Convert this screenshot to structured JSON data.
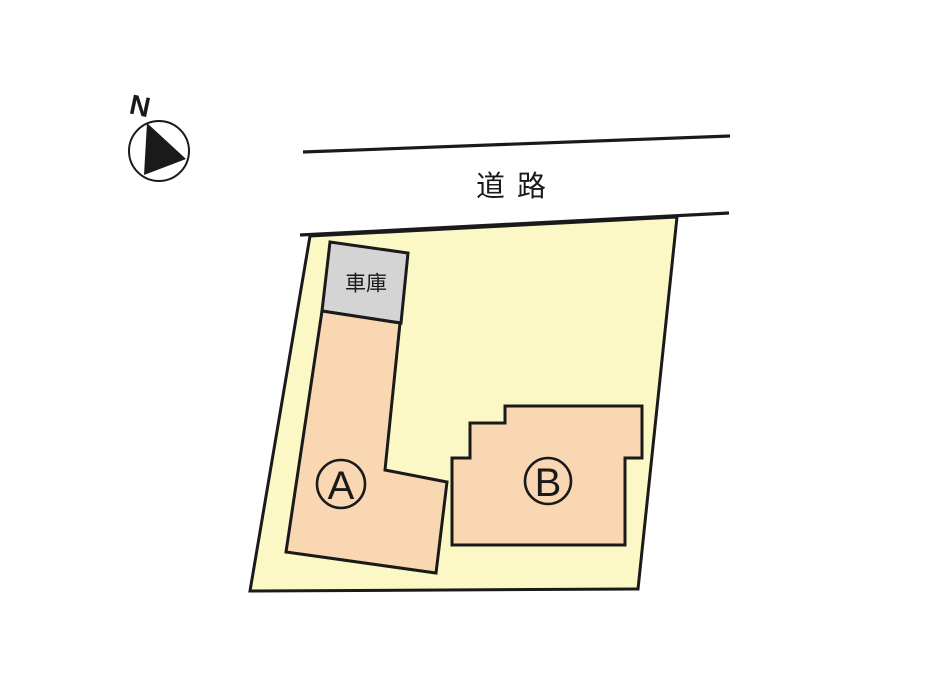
{
  "diagram": {
    "type": "site-plan",
    "compass": {
      "label": "N"
    },
    "road": {
      "label": "道 路"
    },
    "parcel": {
      "description": "land parcel"
    },
    "garage": {
      "label": "車庫"
    },
    "buildings": [
      {
        "id": "A",
        "label": "A"
      },
      {
        "id": "B",
        "label": "B"
      }
    ]
  },
  "colors": {
    "background": "#FFFFFF",
    "parcel": "#FCF8C5",
    "building": "#F9D7B2",
    "garage": "#D4D4D4",
    "line": "#1A1A1A"
  }
}
